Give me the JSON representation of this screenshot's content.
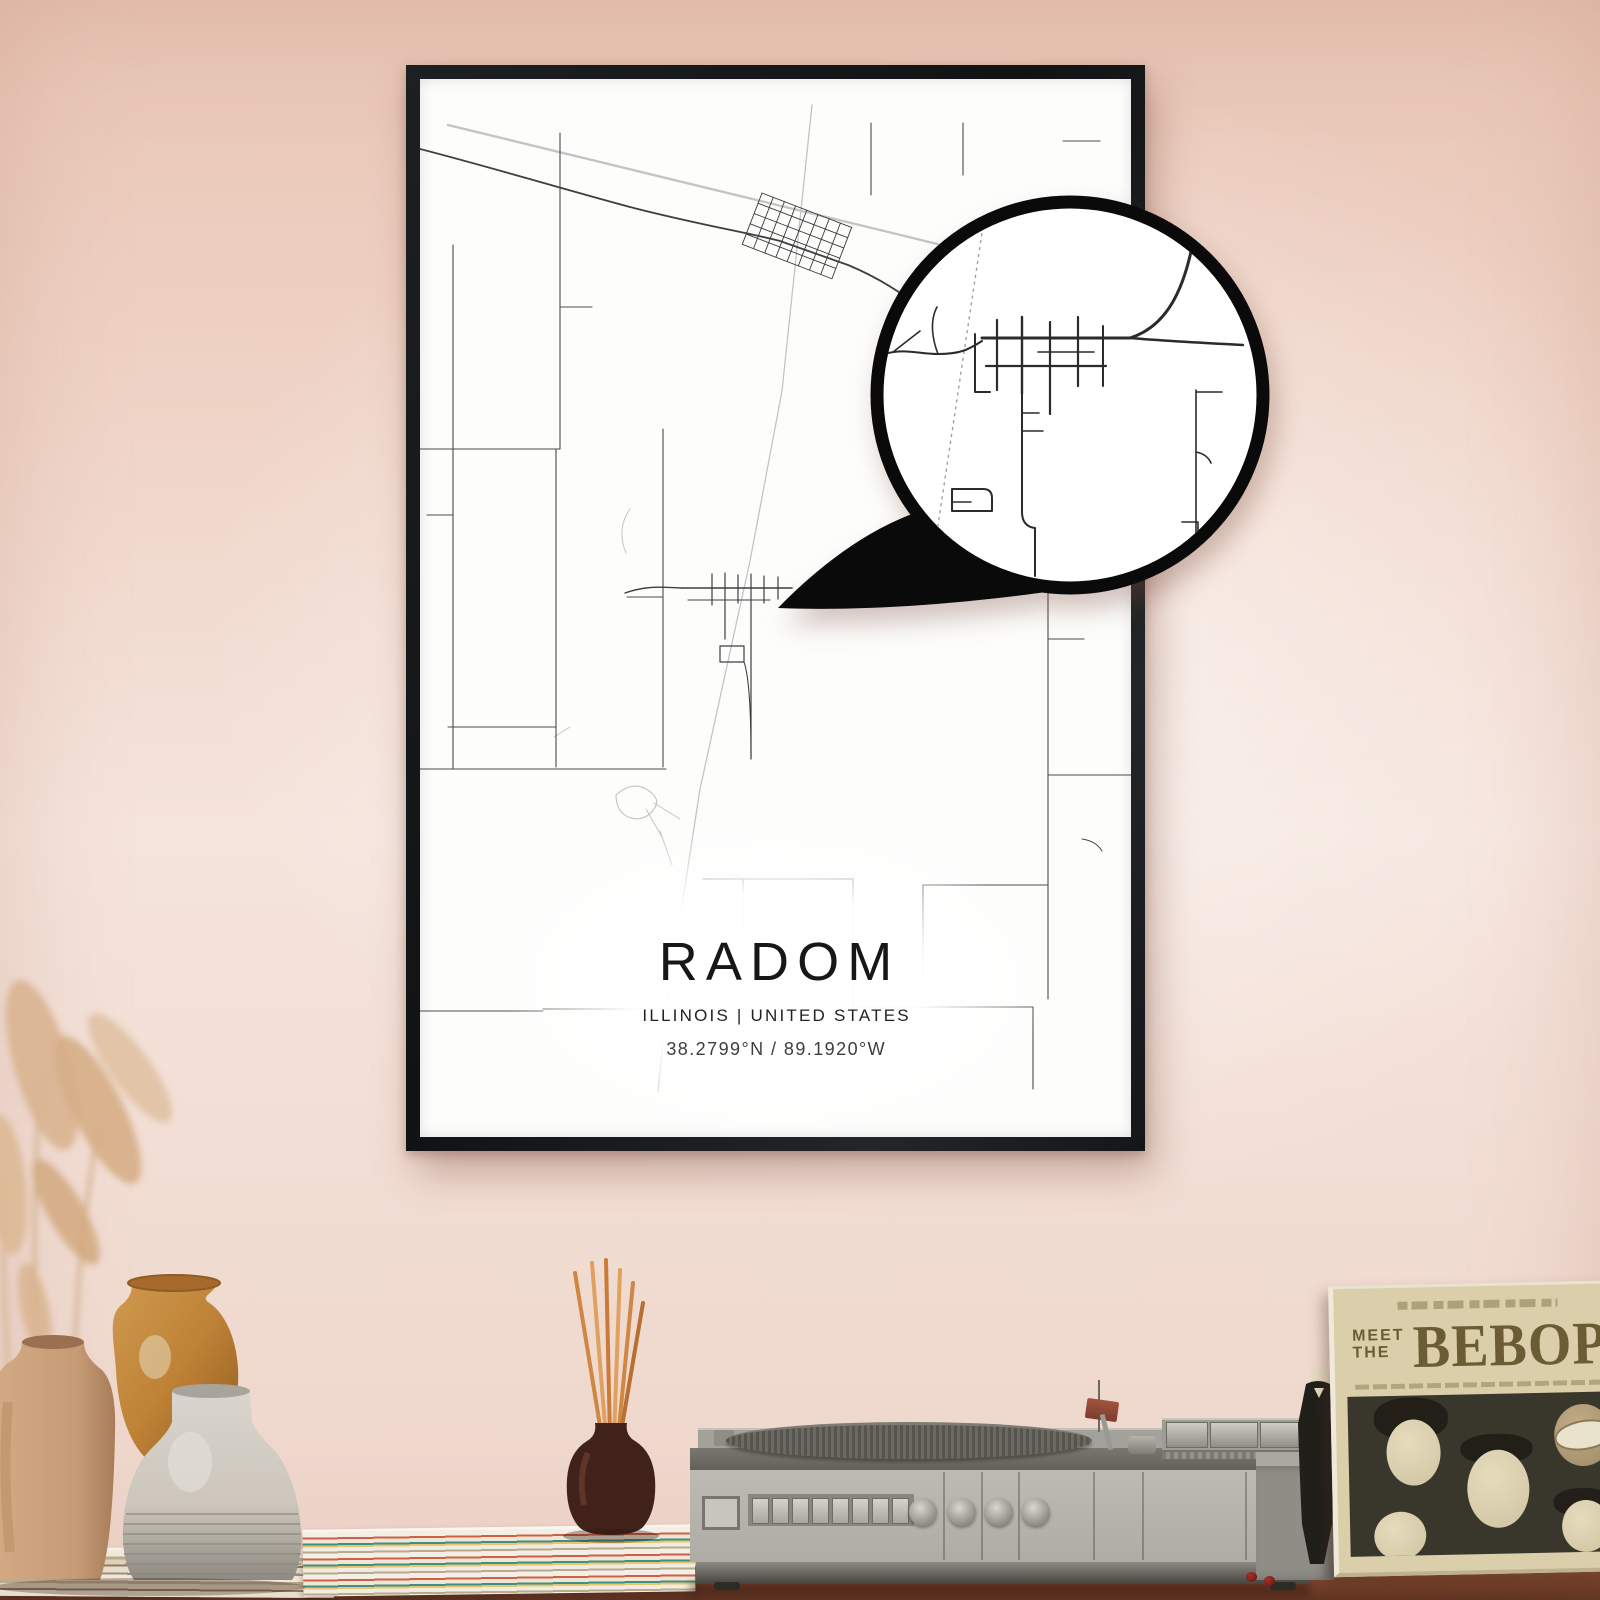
{
  "poster": {
    "title": "RADOM",
    "subtitle": "ILLINOIS | UNITED STATES",
    "coordinates": "38.2799°N / 89.1920°W",
    "frame_color": "#17191c",
    "paper_color": "#fdfdfc",
    "road_color": "#3f3f3f",
    "faint_road_color": "#c4c4c4"
  },
  "magnifier": {
    "ring_color": "#0a0a0a",
    "fill_color": "#ffffff",
    "railroad_color": "#9f9f9f"
  },
  "wall": {
    "base_color": "#edd3c8",
    "highlight_color": "#f8ece5",
    "corner_color": "#e8c4b4"
  },
  "table": {
    "wood_color": "#7c452e"
  },
  "album": {
    "title_word1": "MEET",
    "title_word2": "THE",
    "title_word3": "BEBOP",
    "cover_color": "#dbcfab",
    "ink_color": "#6b5c34",
    "art_background": "#39362c"
  },
  "record_player": {
    "body_color": "#b5b4ac",
    "accent_color": "#62625a",
    "platter_color": "#55544d",
    "button_count": 8,
    "knob_count": 4
  },
  "decor": {
    "vase_tan_color": "#c59b76",
    "vase_amber_color": "#bf8236",
    "vase_white_color": "#ccc6bd",
    "diffuser_color": "#40221a",
    "reed_color": "#cf8743",
    "grass_color": "#d6b28b"
  }
}
